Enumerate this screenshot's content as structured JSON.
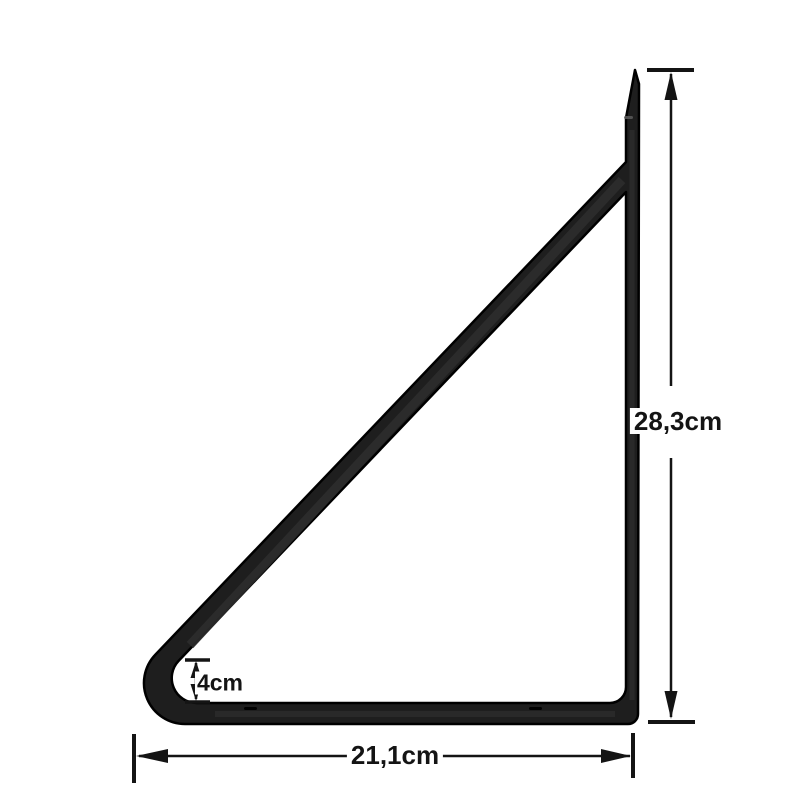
{
  "page": {
    "background_color": "#ffffff"
  },
  "diagram": {
    "kind": "shelf-bracket-dimension-drawing",
    "ink_color": "#141414",
    "metal_fill": "#1e1e1e",
    "metal_edge_color": "#000000",
    "dimensions": {
      "height": {
        "label": "28,3cm"
      },
      "width": {
        "label": "21,1cm"
      },
      "lip": {
        "label": "4cm"
      }
    }
  }
}
